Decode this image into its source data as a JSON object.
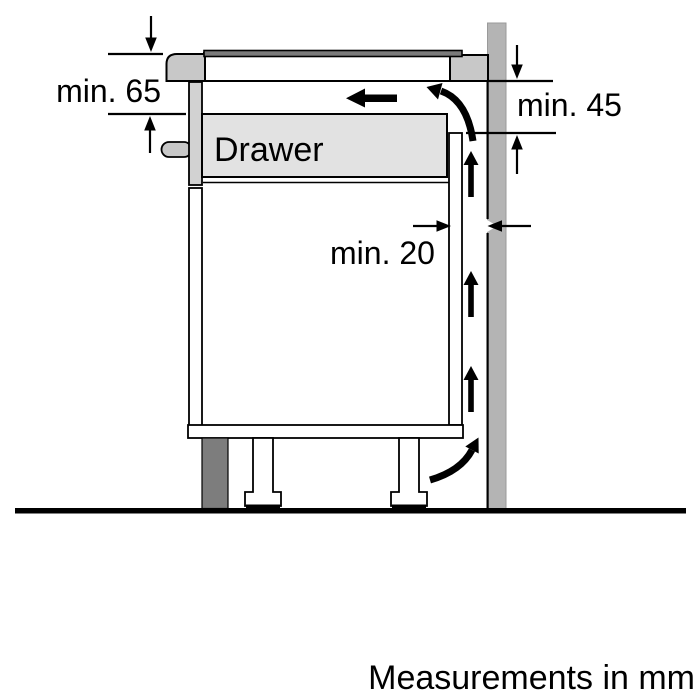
{
  "diagram": {
    "type": "appliance-installation-clearance-side-view",
    "drawer_label": "Drawer",
    "dimensions": [
      {
        "id": "clearance-below-worktop-front",
        "label": "min. 65",
        "value": 65,
        "unit": "mm"
      },
      {
        "id": "clearance-below-worktop-rear",
        "label": "min. 45",
        "value": 45,
        "unit": "mm"
      },
      {
        "id": "gap-cabinet-back-to-wall",
        "label": "min. 20",
        "value": 20,
        "unit": "mm"
      }
    ],
    "footer_note": "Measurements in mm",
    "colors": {
      "wall": "#b4b4b4",
      "panel_light": "#c8c8c8",
      "drawer_front": "#d2d2d2",
      "drawer_fill": "#e2e2e2",
      "hob_glass": "#7a7a7a",
      "plinth": "#7d7d7d",
      "line": "#000000",
      "background": "#ffffff"
    }
  }
}
